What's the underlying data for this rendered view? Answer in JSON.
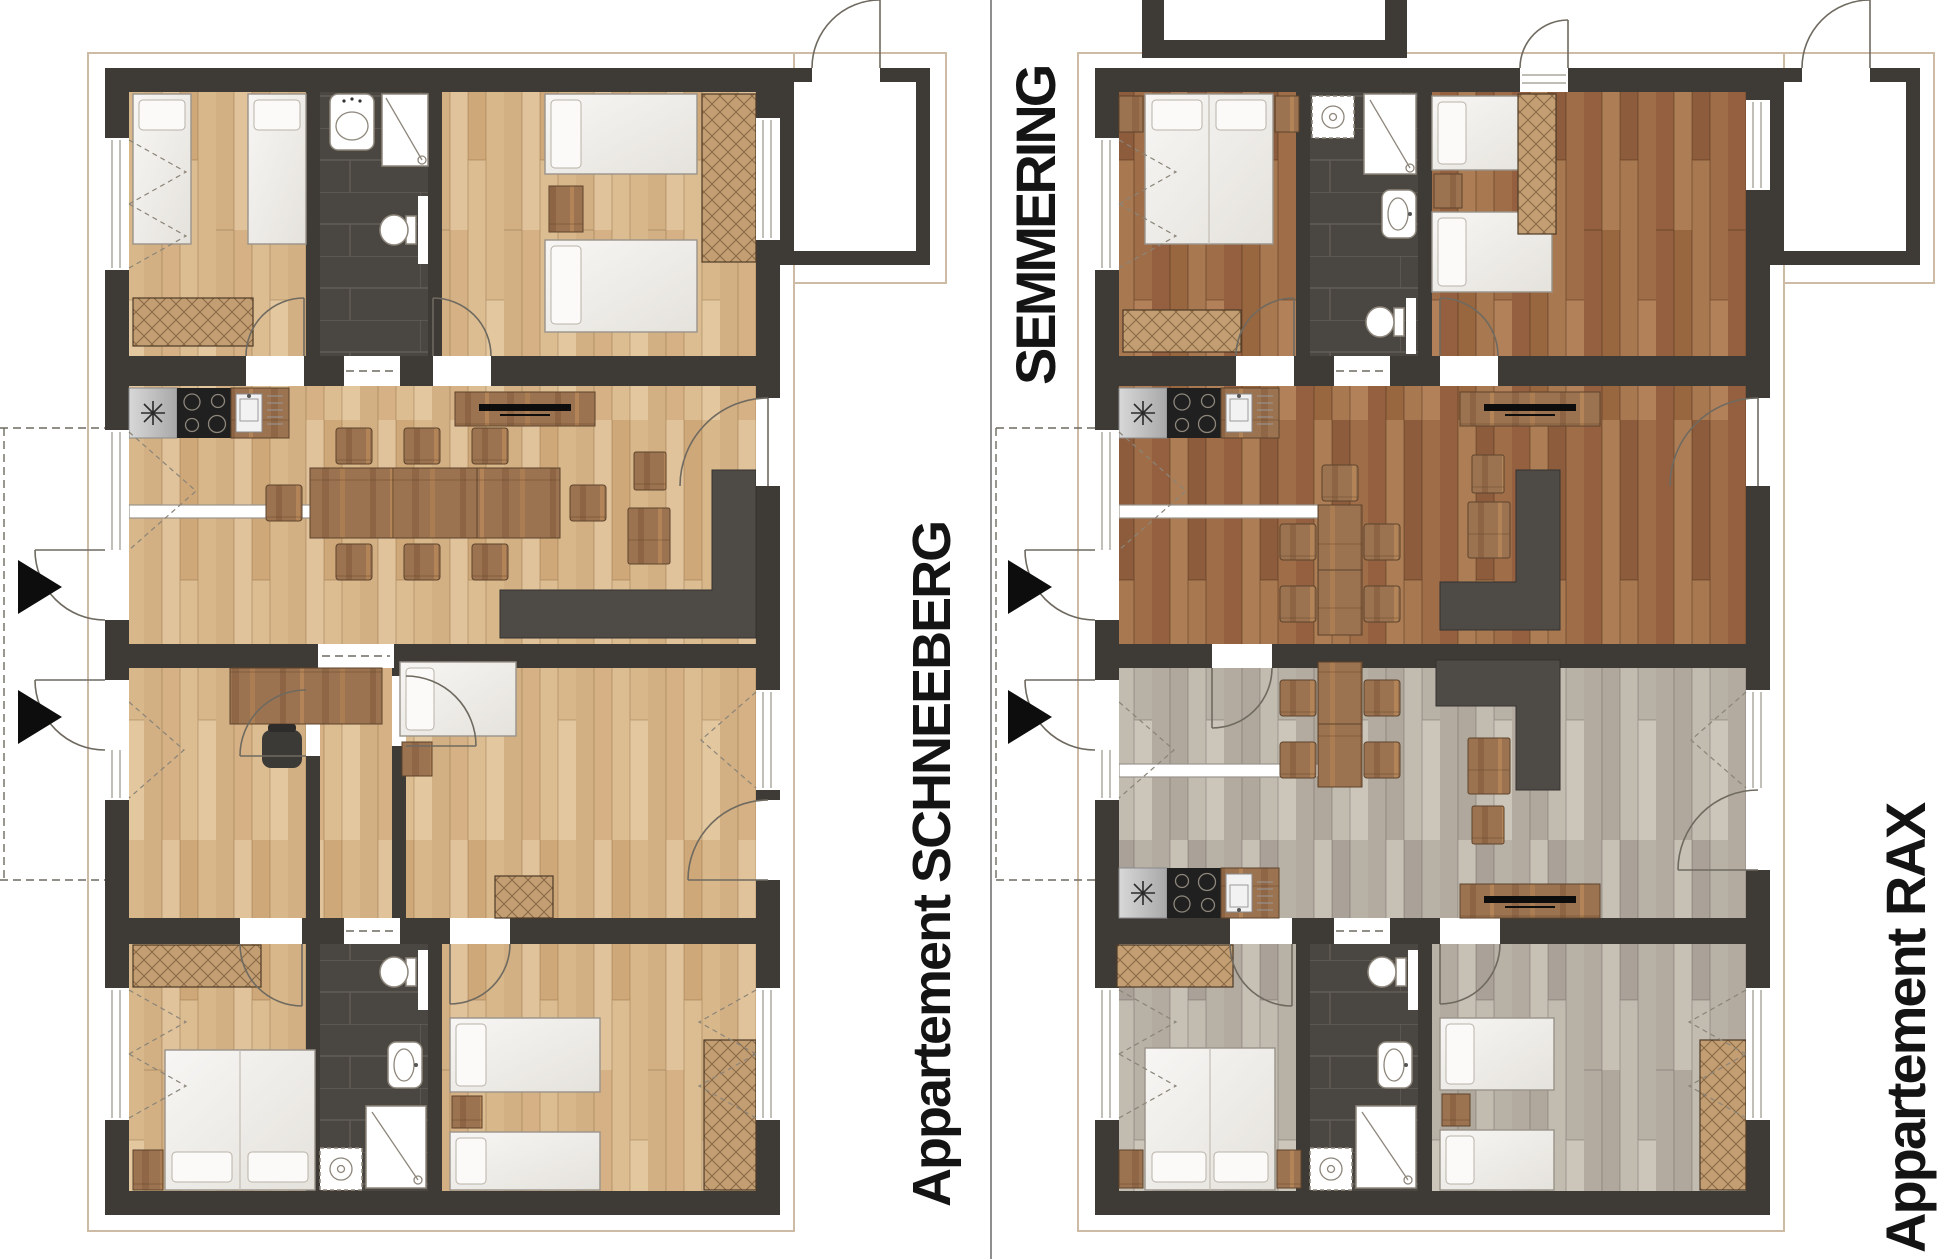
{
  "labels": {
    "schneeberg": "Appartement SCHNEEBERG",
    "semmering": "SEMMERING",
    "rax": "Appartement RAX"
  },
  "icons": {
    "entrance-marker": "solid black triangle pointing right at each apartment entrance door"
  },
  "palette": {
    "wall": "#3e3a35",
    "oak-light": "#d9ba8e",
    "oak-dark": "#a1714b",
    "oak-gray": "#bdb6ab",
    "tile": "#4a4641",
    "wood": "#9c7350",
    "sofa": "#4e4b46",
    "bed": "#f2f0ec",
    "fixture-stroke": "#8d867b",
    "line": "#6f6a60",
    "outline": "#cdbba6",
    "divider": "#8f8f8f",
    "triangle": "#0d0d0d",
    "label-ink": "#141414",
    "paper": "#ffffff"
  }
}
